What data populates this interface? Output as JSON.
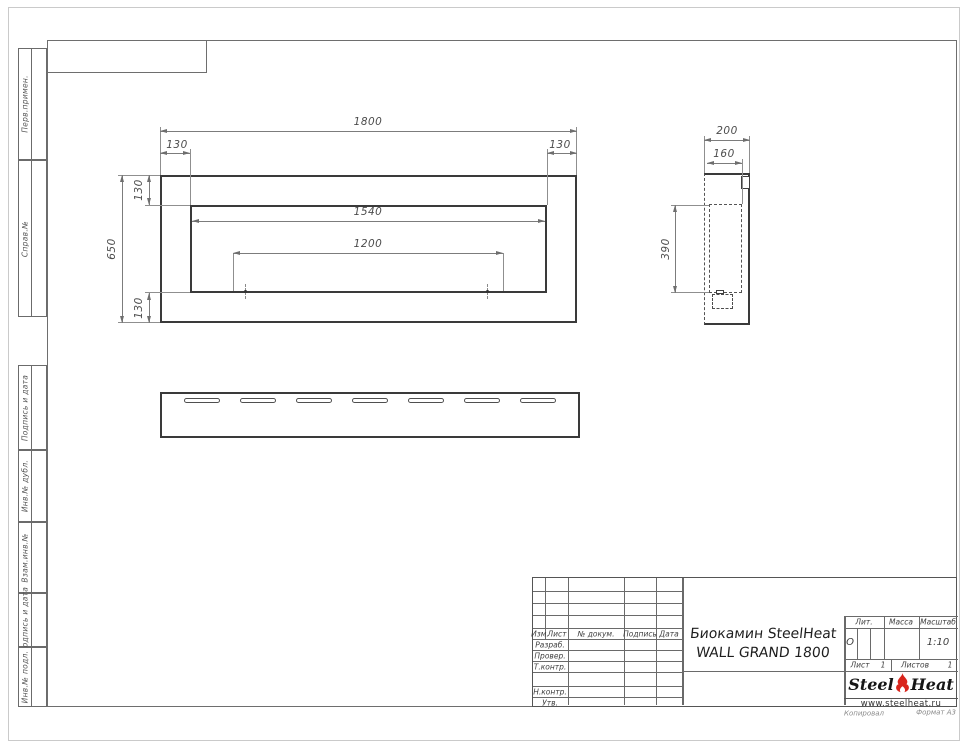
{
  "sidebar": {
    "items": [
      {
        "label": "Перв.примен."
      },
      {
        "label": "Справ.№"
      },
      {
        "label": "Подпись и дата"
      },
      {
        "label": "Инв.№ дубл."
      },
      {
        "label": "Взам.инв.№"
      },
      {
        "label": "Подпись и дата"
      },
      {
        "label": "Инв.№ подл."
      }
    ]
  },
  "front_view": {
    "dim_total_width": "1800",
    "dim_margin_left": "130",
    "dim_margin_right": "130",
    "dim_total_height": "650",
    "dim_margin_top": "130",
    "dim_margin_bottom": "130",
    "dim_opening_width": "1540",
    "dim_mount_span": "1200"
  },
  "side_view": {
    "dim_depth": "200",
    "dim_inner_depth": "160",
    "dim_inner_height": "390"
  },
  "title_block": {
    "rev_cols": {
      "izm": "Изм.",
      "list": "Лист",
      "doc": "№ докум.",
      "podpis": "Подпись",
      "data": "Дата"
    },
    "roles": {
      "razrab": "Разраб.",
      "prover": "Провер.",
      "tkontr": "Т.контр.",
      "nkontr": "Н.контр.",
      "utv": "Утв."
    },
    "title_line1": "Биокамин SteelHeat",
    "title_line2": "WALL GRAND 1800",
    "lit_label": "Лит.",
    "lit_value": "О",
    "massa_label": "Масса",
    "scale_label": "Масштаб",
    "scale_value": "1:10",
    "list_label": "Лист",
    "list_value": "1",
    "listov_label": "Листов",
    "listov_value": "1",
    "logo_steel": "Steel",
    "logo_heat": "Heat",
    "logo_url": "www.steelheat.ru"
  },
  "footer": {
    "kopiroval": "Копировал",
    "format": "Формат А3"
  }
}
